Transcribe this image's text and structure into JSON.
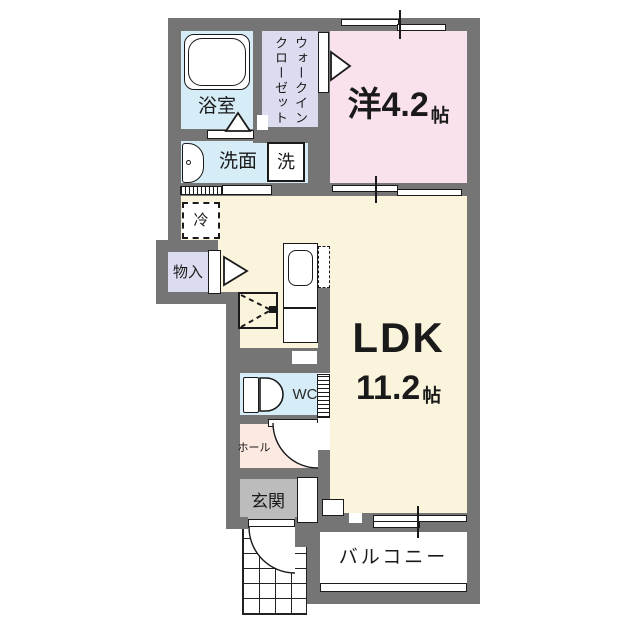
{
  "plan": {
    "title": "apartment-floor-plan",
    "rooms": {
      "bathroom": {
        "label": "浴室"
      },
      "walk_in_closet": {
        "label": "ウォークインクローゼット",
        "label_col_right": "ウォークイン",
        "label_col_left": "クローゼット"
      },
      "western_room": {
        "label": "洋",
        "size": "4.2",
        "unit": "帖"
      },
      "washroom": {
        "label": "洗面"
      },
      "washer": {
        "label": "洗"
      },
      "fridge": {
        "label": "冷"
      },
      "storage": {
        "label": "物入"
      },
      "ldk": {
        "label": "LDK",
        "size": "11.2",
        "unit": "帖"
      },
      "wc": {
        "label": "WC"
      },
      "hall": {
        "label": "ホール"
      },
      "entrance": {
        "label": "玄関"
      },
      "balcony": {
        "label": "バルコニー"
      }
    },
    "colors": {
      "wall": "#757575",
      "wet_area_blue": "#d6ecf6",
      "closet_lavender": "#dcdcf0",
      "bedroom_pink": "#f9e2ee",
      "hall_peach": "#fce9e2",
      "ldk_cream": "#fbf4dd",
      "entrance_gray": "#bcbcbc",
      "line": "#1a1a1a"
    }
  }
}
